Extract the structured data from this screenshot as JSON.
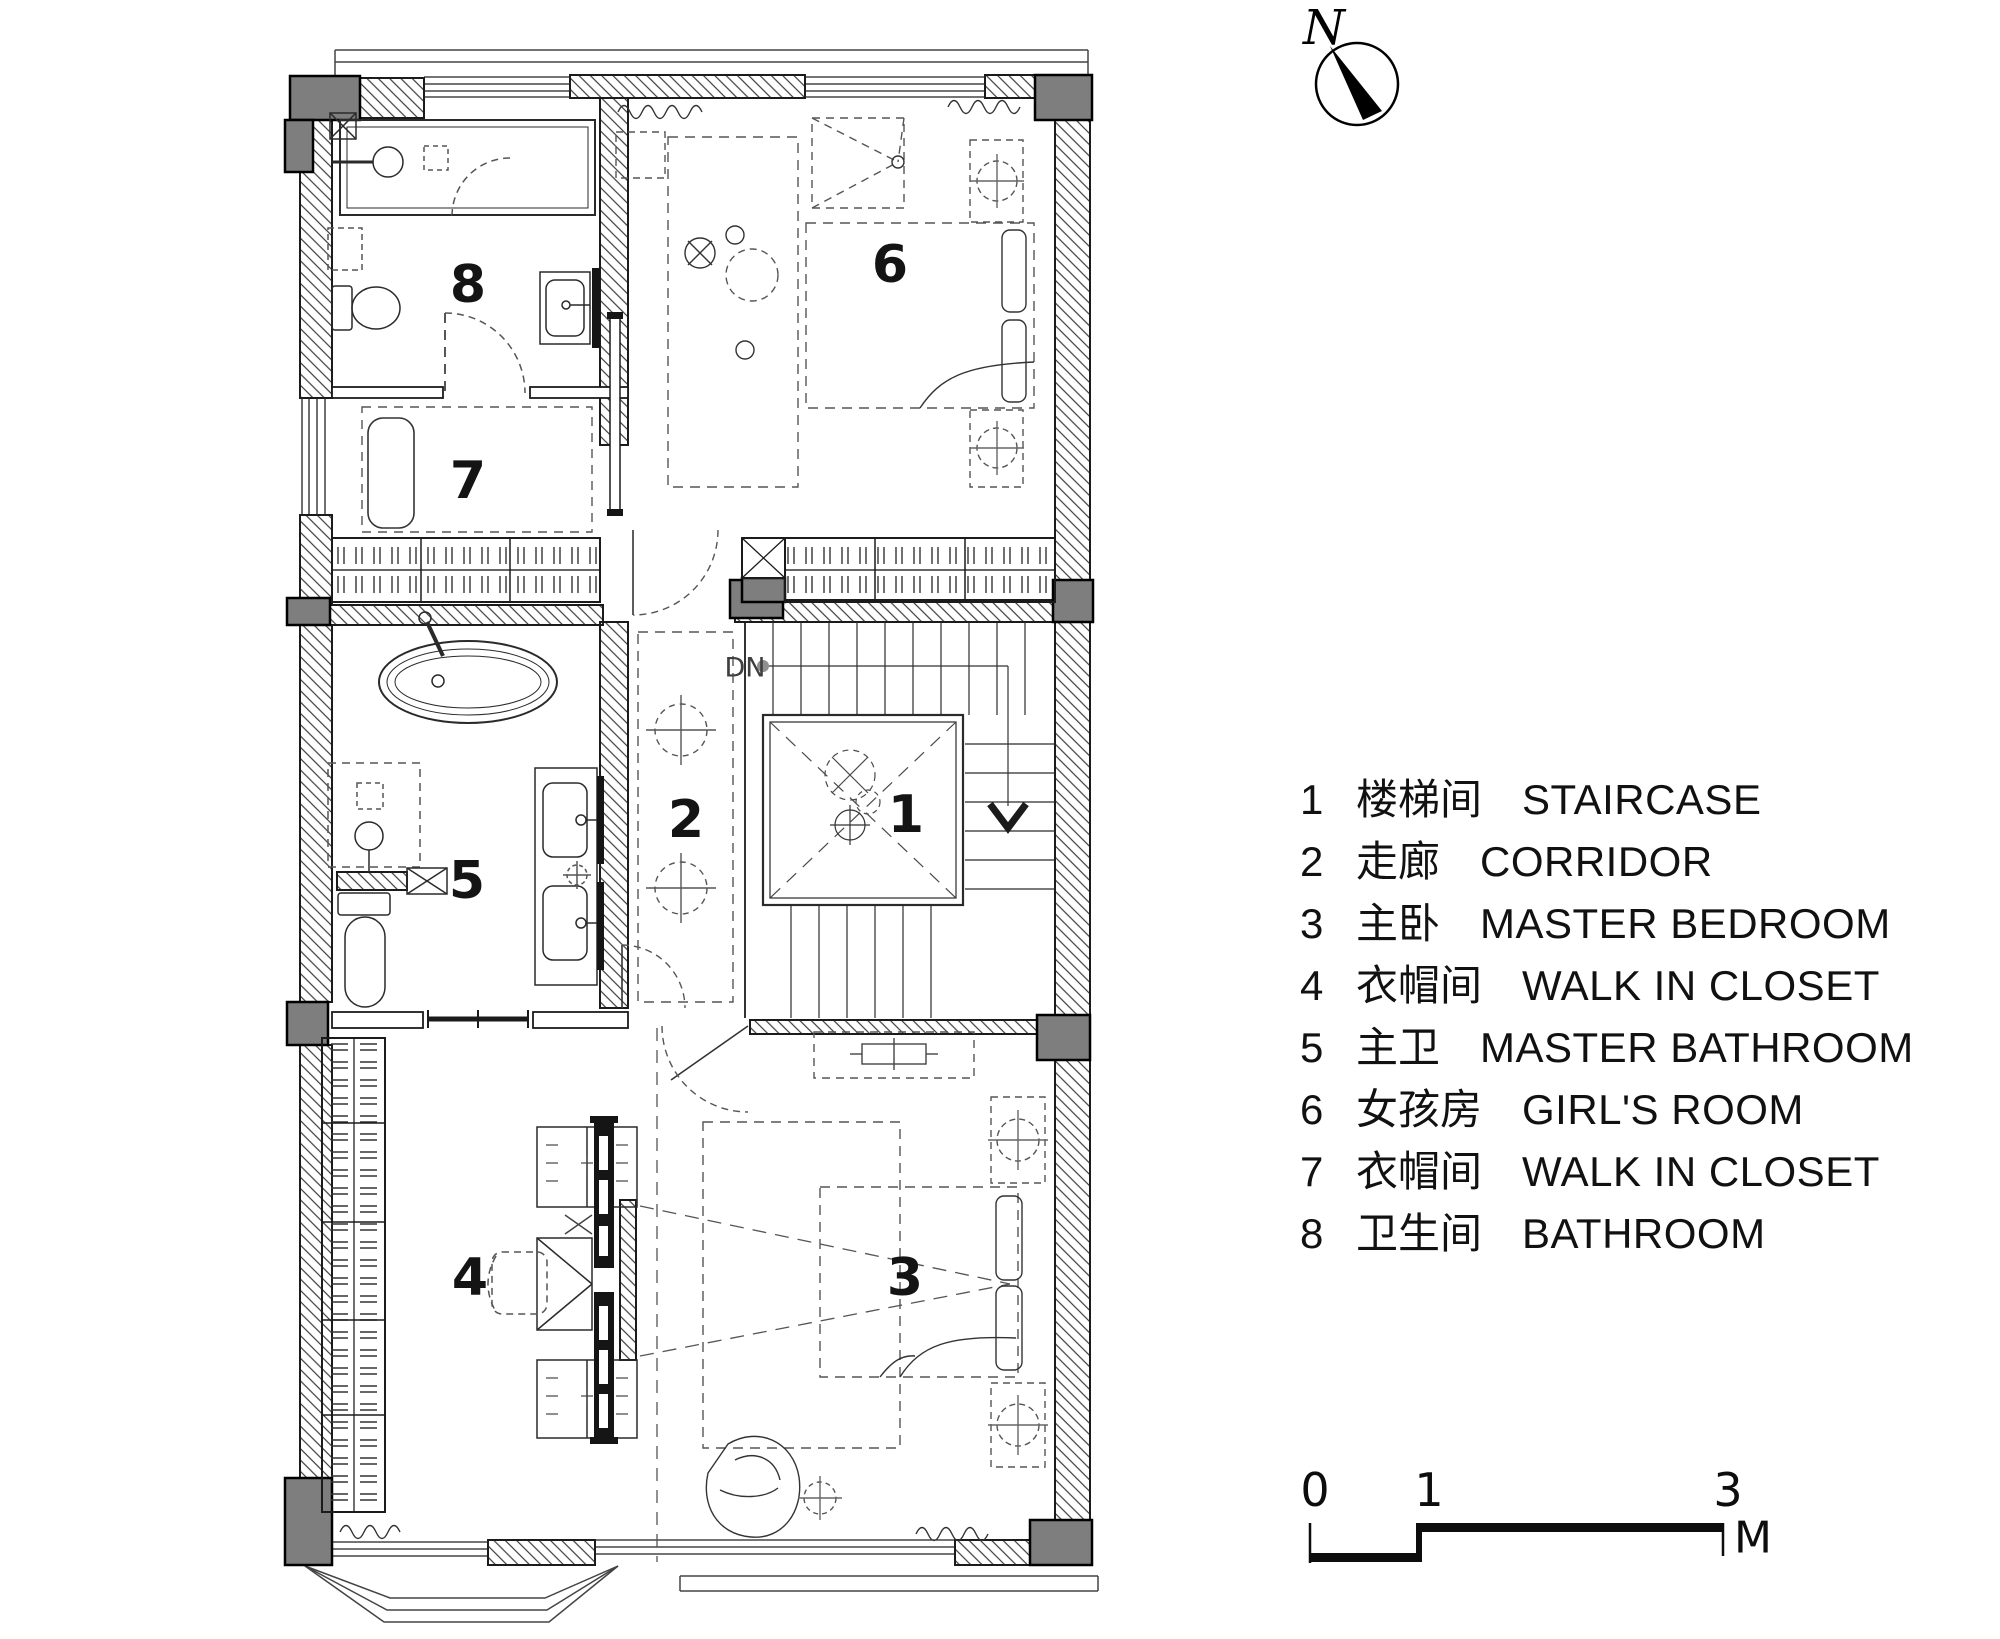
{
  "compass": {
    "label": "N",
    "icon": "north-arrow-icon"
  },
  "plan": {
    "room_labels": [
      "1",
      "2",
      "3",
      "4",
      "5",
      "6",
      "7",
      "8"
    ],
    "stair_direction_label": "DN"
  },
  "legend": {
    "items": [
      {
        "num": "1",
        "zh": "楼梯间",
        "en": "STAIRCASE"
      },
      {
        "num": "2",
        "zh": "走廊",
        "en": "CORRIDOR"
      },
      {
        "num": "3",
        "zh": "主卧",
        "en": "MASTER BEDROOM"
      },
      {
        "num": "4",
        "zh": "衣帽间",
        "en": "WALK IN CLOSET"
      },
      {
        "num": "5",
        "zh": "主卫",
        "en": "MASTER BATHROOM"
      },
      {
        "num": "6",
        "zh": "女孩房",
        "en": "GIRL'S ROOM"
      },
      {
        "num": "7",
        "zh": "衣帽间",
        "en": "WALK IN CLOSET"
      },
      {
        "num": "8",
        "zh": "卫生间",
        "en": "BATHROOM"
      }
    ]
  },
  "scale_bar": {
    "ticks": [
      "0",
      "1",
      "3"
    ],
    "unit": "M"
  },
  "colors": {
    "wall_line": "#1b1b1b",
    "column_fill": "#7e7e7e",
    "furniture_dash": "#555555"
  }
}
